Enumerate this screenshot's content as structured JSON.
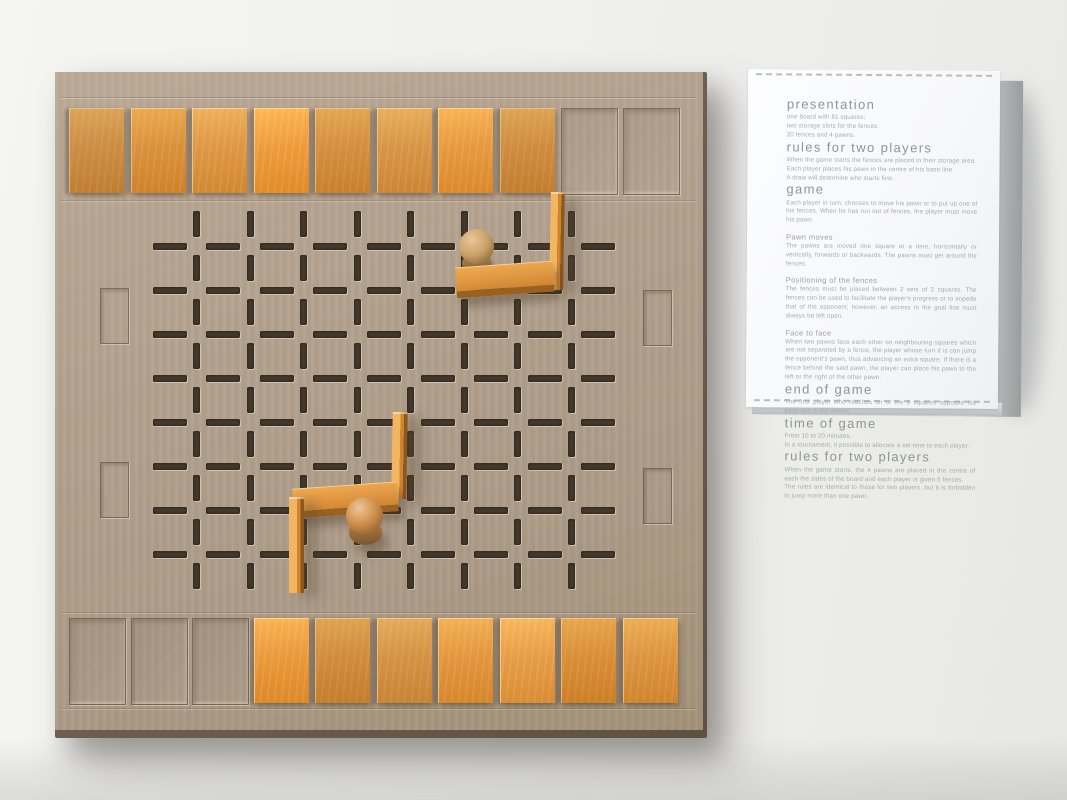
{
  "photo": {
    "background_color": "#f0f0ee",
    "desk_shadow_color": "#d9dad8"
  },
  "board": {
    "cardboard_color": "#b3a28e",
    "edge_color": "#5e5144",
    "fence_color": "#dd9440",
    "grid": {
      "rows": 9,
      "cols": 9
    },
    "storage": {
      "top_slots": [
        1,
        1,
        1,
        1,
        1,
        1,
        1,
        1,
        0,
        0
      ],
      "bottom_slots": [
        0,
        0,
        0,
        1,
        1,
        1,
        1,
        1,
        1,
        1
      ]
    },
    "side_slots": {
      "left_count": 2,
      "right_count": 2
    },
    "pieces": {
      "fences_on_board": [
        {
          "kind": "standing",
          "x": 550,
          "y": 192,
          "w": 14,
          "h": 98,
          "z": 3,
          "rot": 1
        },
        {
          "kind": "flat",
          "x": 456,
          "y": 264,
          "w": 98,
          "h": 24,
          "z": 5,
          "rot": -4
        },
        {
          "kind": "standing",
          "x": 392,
          "y": 412,
          "w": 15,
          "h": 87,
          "z": 3,
          "rot": 1
        },
        {
          "kind": "flat",
          "x": 293,
          "y": 485,
          "w": 105,
          "h": 23,
          "z": 4,
          "rot": -4
        },
        {
          "kind": "standing",
          "x": 289,
          "y": 497,
          "w": 15,
          "h": 96,
          "z": 4,
          "rot": 0
        }
      ],
      "pawns": [
        {
          "tone": "light",
          "ball": {
            "x": 459,
            "y": 229,
            "d": 35
          },
          "base": {
            "x": 462,
            "y": 254,
            "w": 30,
            "h": 20
          },
          "z": 4,
          "ball_color": "#c9a169",
          "base_color": "#b08a58"
        },
        {
          "tone": "orange",
          "ball": {
            "x": 346,
            "y": 497,
            "d": 37
          },
          "base": {
            "x": 349,
            "y": 521,
            "w": 33,
            "h": 24
          },
          "z": 6,
          "ball_color": "#cd8d4a",
          "base_color": "#c07f3d"
        }
      ]
    }
  },
  "rules_sheet": {
    "paper_color": "#fafbfc",
    "heading_color": "#8f9496",
    "body_color": "#a6abac",
    "sections": [
      {
        "level": 1,
        "title": "presentation",
        "lines": [
          "one board with 81 squares;",
          "two storage slots for the fences;",
          "20 fences and 4 pawns."
        ]
      },
      {
        "level": 1,
        "title": "rules for two players",
        "lines": [
          "When the game starts the fences are placed in their storage area.",
          "Each player places his pawn in the centre of his base line.",
          "A draw will determine who starts first."
        ]
      },
      {
        "level": 1,
        "title": "game",
        "lines": [
          "Each player in turn, chooses to move his pawn or to put up one of his fences. When he has run out of fences, the player must move his pawn."
        ]
      },
      {
        "level": 2,
        "title": "Pawn moves",
        "lines": [
          "The pawns are moved one square at a time, horizontally or vertically, forwards or backwards. The pawns must get around the fences."
        ]
      },
      {
        "level": 2,
        "title": "Positioning of the fences",
        "lines": [
          "The fences must be placed between 2 sets of 2 squares. The fences can be used to facilitate the player's progress or to impede that of the opponent; however, an access to the goal line must always be left open."
        ]
      },
      {
        "level": 2,
        "title": "Face to face",
        "lines": [
          "When two pawns face each other on neighbouring squares which are not separated by a fence, the player whose turn it is can jump the opponent's pawn, thus advancing an extra square. If there is a fence behind the said pawn, the player can place his pawn to the left or the right of the other pawn."
        ]
      },
      {
        "level": 1,
        "title": "end of game",
        "lines": [
          "The first player who reaches on of the 9 squares opposite his base line is the winner."
        ]
      },
      {
        "level": 1,
        "title": "time of game",
        "lines": [
          "From 10 to 20 minutes.",
          "In a tournament, it possible to allocate a set time to each player."
        ]
      },
      {
        "level": 1,
        "title": "rules for two players",
        "lines": [
          "When the game starts, the 4 pawns are placed in the centre of each the sides of the board and each player is given 5 fences.",
          "The rules are identical to those for two players, but it is forbidden to jump more than one pawn."
        ]
      }
    ]
  }
}
